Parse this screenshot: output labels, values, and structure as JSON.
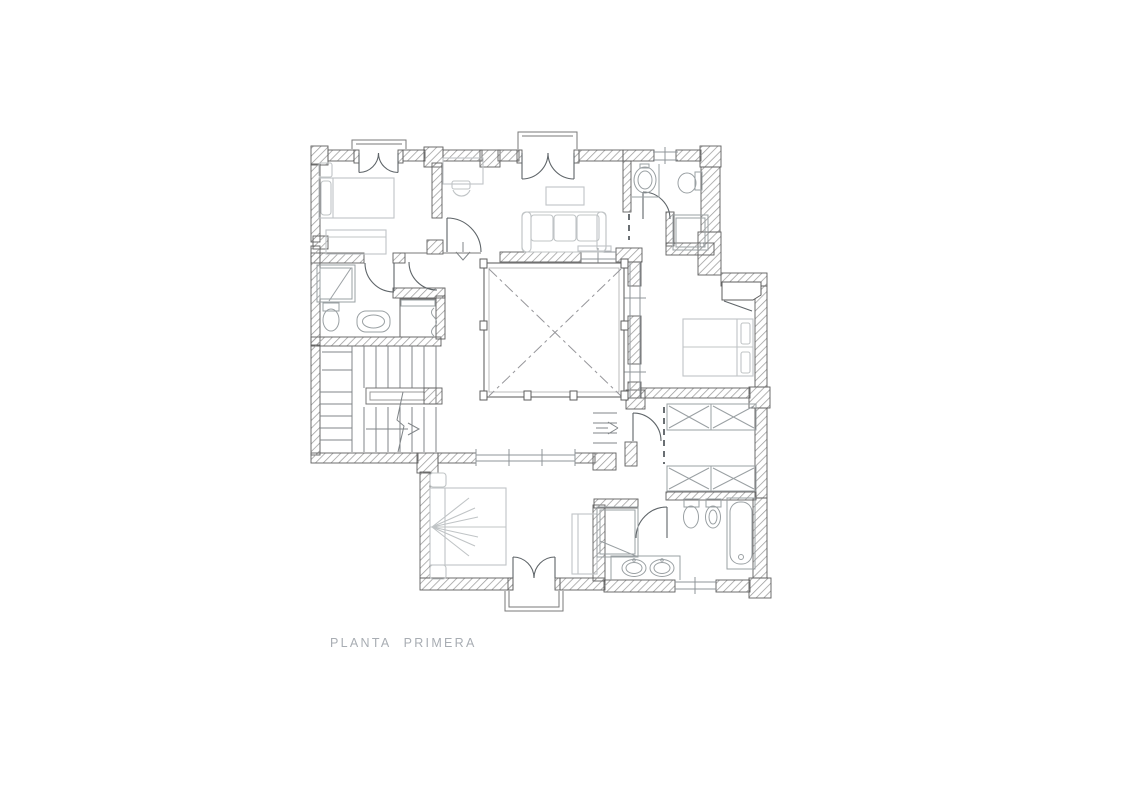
{
  "meta": {
    "type": "architectural-floor-plan",
    "sheet_background": "#ffffff"
  },
  "caption": {
    "text": "PLANTA PRIMERA"
  },
  "colors": {
    "wall_hatch": "#9b9b9b",
    "wall_outline": "#5e5e5e",
    "door_line": "#5f6569",
    "furniture_light": "#c0c4c6",
    "fixture": "#9aa0a3",
    "glazing": "#8f9499",
    "void_diagonal": "#97979b",
    "stair_line": "#808588",
    "caption_text": "#a8adb3"
  }
}
